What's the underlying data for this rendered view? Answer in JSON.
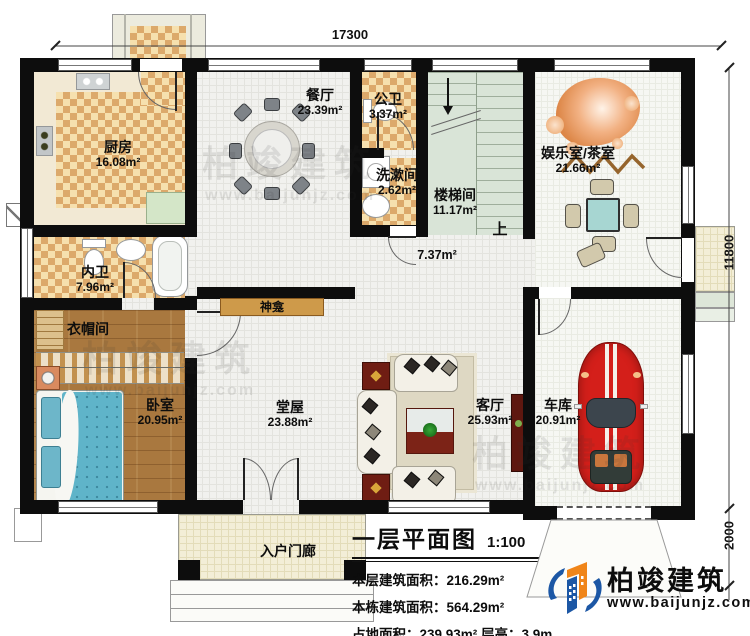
{
  "dimensions": {
    "width_top": "17300",
    "height_right": "11800",
    "porch_depth": "2000"
  },
  "rooms": {
    "kitchen": {
      "name": "厨房",
      "area": "16.08m²"
    },
    "dining": {
      "name": "餐厅",
      "area": "23.39m²"
    },
    "public_wc": {
      "name": "公卫",
      "area": "3.37m²"
    },
    "washroom": {
      "name": "洗漱间",
      "area": "2.62m²"
    },
    "stairwell": {
      "name": "楼梯间",
      "area": "11.17m²"
    },
    "entertainment": {
      "name": "娱乐室/茶室",
      "area": "21.66m²"
    },
    "corridor": {
      "area": "7.37m²"
    },
    "inner_wc": {
      "name": "内卫",
      "area": "7.96m²"
    },
    "cloakroom": {
      "name": "衣帽间"
    },
    "bedroom": {
      "name": "卧室",
      "area": "20.95m²"
    },
    "hall": {
      "name": "堂屋",
      "area": "23.88m²"
    },
    "living": {
      "name": "客厅",
      "area": "25.93m²"
    },
    "garage": {
      "name": "车库",
      "area": "20.91m²"
    },
    "entry_porch": {
      "name": "入户门廊"
    },
    "shrine": {
      "name": "神龛"
    },
    "stairs_up": {
      "label": "上"
    }
  },
  "title_block": {
    "title": "一层平面图",
    "scale": "1:100",
    "stat1": "本层建筑面积：216.29m²",
    "stat2": "本栋建筑面积：564.29m²",
    "stat3": "占地面积：239.93m²  层高：3.9m"
  },
  "logo": {
    "name": "柏竣建筑",
    "url": "www.baijunjz.com"
  },
  "watermark": {
    "name": "柏竣建筑",
    "url": "www.baijunjz.com"
  },
  "colors": {
    "wall": "#0d0d0d",
    "checker": "#dca96b",
    "wood": "#a9783f",
    "stair": "#d9e4d7",
    "car_red": "#d41f1a",
    "logo_blue": "#1c57a5",
    "logo_orange": "#f08519"
  }
}
